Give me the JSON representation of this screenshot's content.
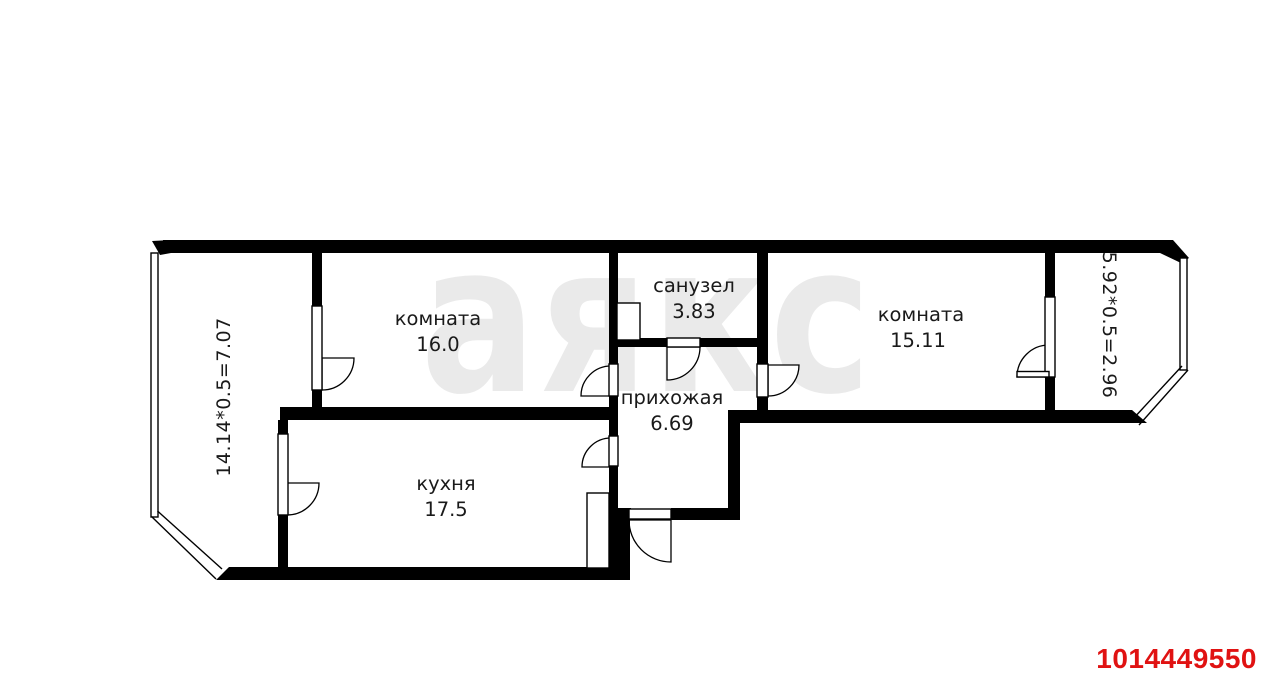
{
  "plan_title": "floor-plan",
  "watermark": {
    "text": "аякс",
    "color": "#eaeaea"
  },
  "listing_id": {
    "value": "1014449550",
    "color": "#e01212"
  },
  "rooms": [
    {
      "key": "room-1",
      "name": "комната",
      "area": "16.0"
    },
    {
      "key": "bathroom",
      "name": "санузел",
      "area": "3.83"
    },
    {
      "key": "room-2",
      "name": "комната",
      "area": "15.11"
    },
    {
      "key": "hallway",
      "name": "прихожая",
      "area": "6.69"
    },
    {
      "key": "kitchen",
      "name": "кухня",
      "area": "17.5"
    }
  ],
  "balconies": [
    {
      "key": "balcony-left",
      "label": "14.14*0.5=7.07"
    },
    {
      "key": "balcony-right",
      "label": "5.92*0.5=2.96"
    }
  ],
  "colors": {
    "wall": "#000000",
    "background": "#ffffff"
  }
}
